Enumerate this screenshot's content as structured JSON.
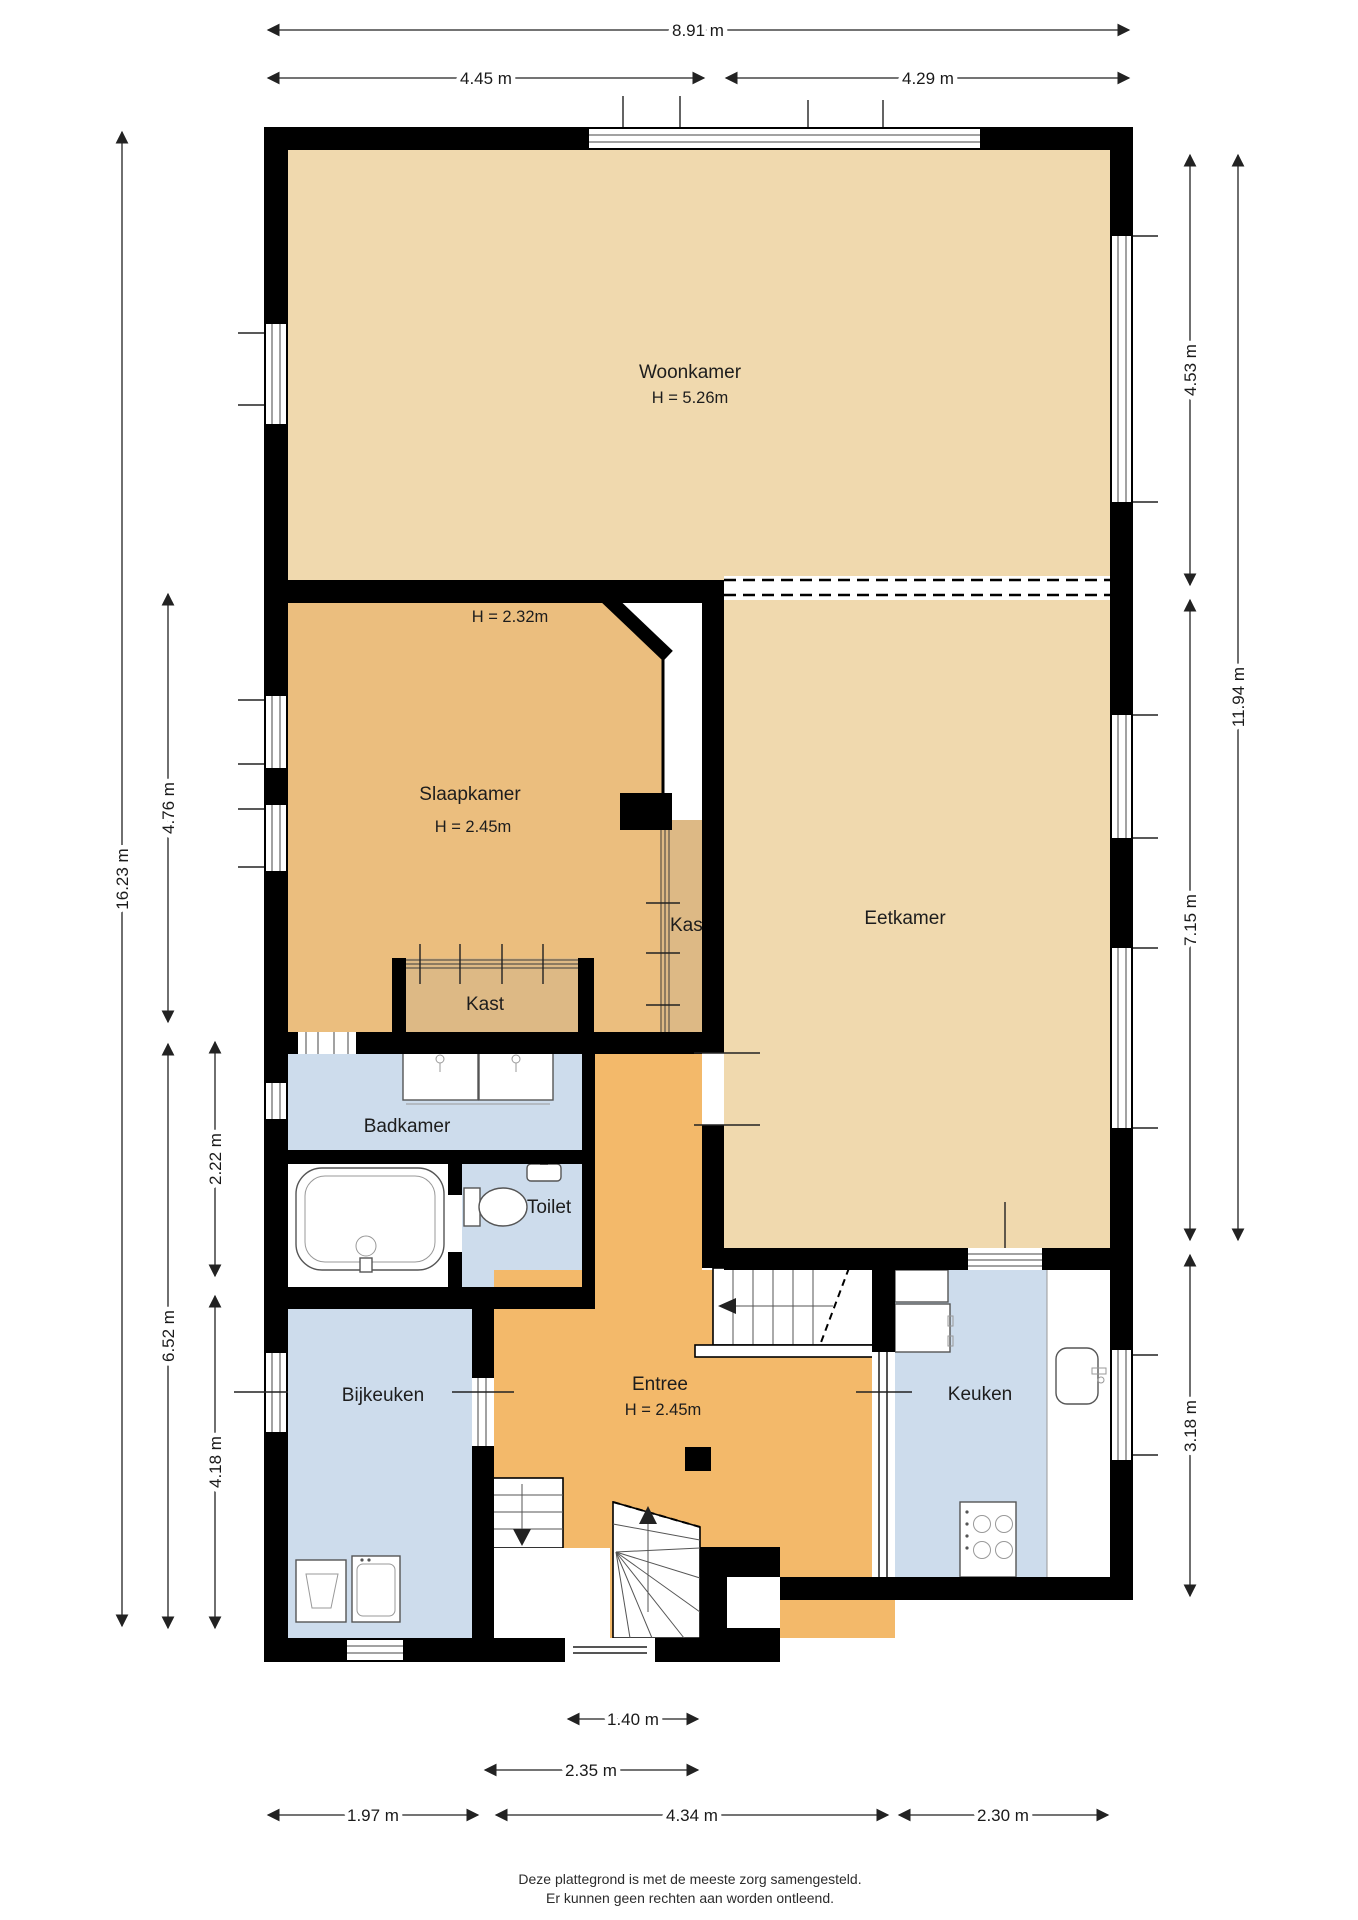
{
  "colors": {
    "wall": "#000000",
    "living_tan": "#F0D9AE",
    "bedroom_ochre": "#EBBE7E",
    "closet_tan": "#DDB985",
    "hall_orange": "#F3B96A",
    "wet_blue": "#CDDCEC",
    "dim_line": "#222222"
  },
  "rooms": {
    "woonkamer": {
      "label": "Woonkamer",
      "height": "H = 5.26m"
    },
    "slaapkamer": {
      "label": "Slaapkamer",
      "height": "H = 2.45m",
      "ceiling_note": "H = 2.32m"
    },
    "eetkamer": {
      "label": "Eetkamer"
    },
    "kast_wall": {
      "label": "Kast"
    },
    "kast_closet": {
      "label": "Kast"
    },
    "badkamer": {
      "label": "Badkamer"
    },
    "toilet": {
      "label": "Toilet"
    },
    "bijkeuken": {
      "label": "Bijkeuken"
    },
    "entree": {
      "label": "Entree",
      "height": "H = 2.45m"
    },
    "keuken": {
      "label": "Keuken"
    }
  },
  "dimensions": {
    "top_total": "8.91 m",
    "top_left": "4.45 m",
    "top_right": "4.29 m",
    "left_total": "16.23 m",
    "left_slaapkamer": "4.76 m",
    "left_badkamer": "2.22 m",
    "left_lower": "6.52 m",
    "left_bijkeuken": "4.18 m",
    "right_woonkamer": "4.53 m",
    "right_total": "11.94 m",
    "right_eetkamer": "7.15 m",
    "right_keuken": "3.18 m",
    "bottom_voordeur": "1.40 m",
    "bottom_portaal": "2.35 m",
    "bottom_bijkeuken": "1.97 m",
    "bottom_entree": "4.34 m",
    "bottom_keuken": "2.30 m"
  },
  "footer": {
    "line1": "Deze plattegrond is met de meeste zorg samengesteld.",
    "line2": "Er kunnen geen rechten aan worden ontleend."
  }
}
